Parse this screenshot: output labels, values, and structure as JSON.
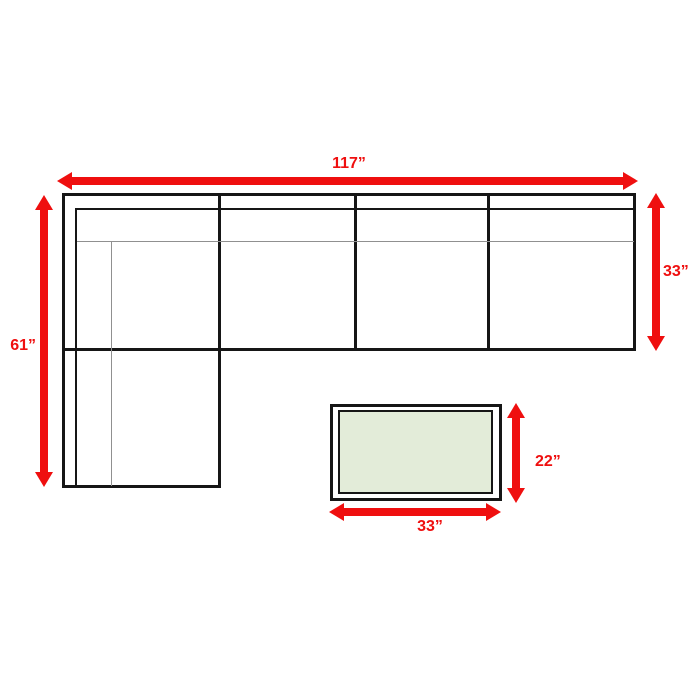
{
  "diagram": {
    "type": "furniture-dimensions",
    "items": {
      "sectional_sofa": {
        "overall_width_label": "117”",
        "chaise_depth_label": "61”",
        "body_depth_label": "33”",
        "seat_sections": 4
      },
      "coffee_table": {
        "width_label": "33”",
        "depth_label": "22”"
      }
    },
    "colors": {
      "dimension_red": "#ef0f0f",
      "outline_black": "#161616",
      "cushion_gray": "#909090",
      "table_top_green": "#e3ecd9",
      "background": "#ffffff"
    }
  }
}
